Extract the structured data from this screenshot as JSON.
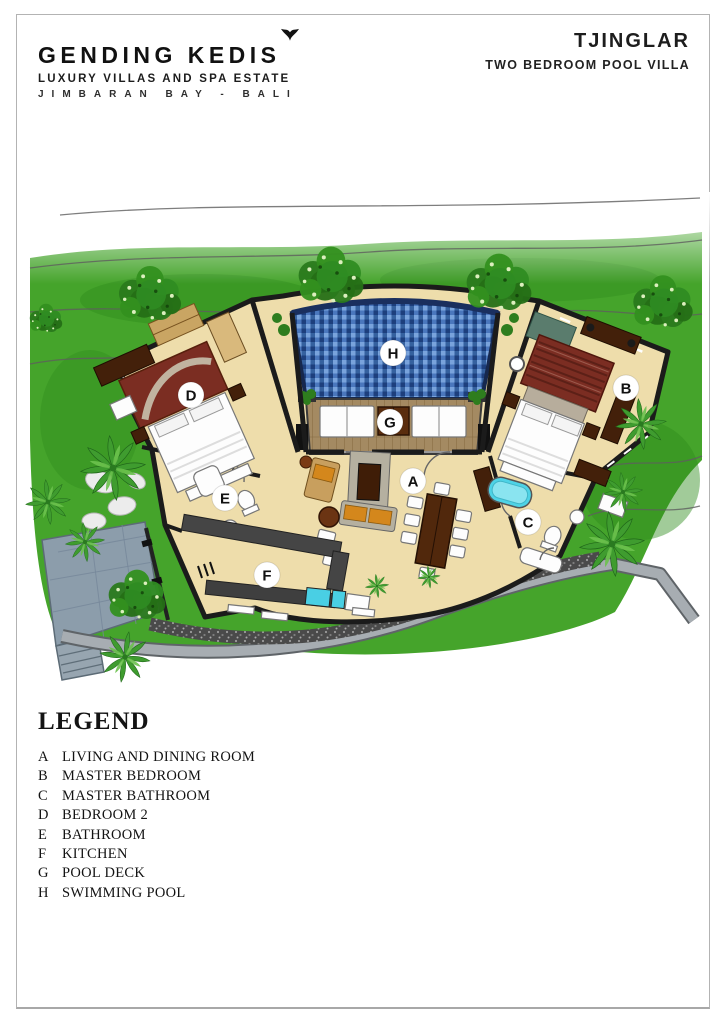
{
  "header": {
    "brand": {
      "name": "GENDING KEDIS",
      "tagline": "LUXURY VILLAS AND SPA ESTATE",
      "location": "JIMBARAN BAY  -  BALI",
      "logo_mark": "bird-icon"
    },
    "villa": {
      "name": "TJINGLAR",
      "type": "TWO BEDROOM POOL VILLA"
    }
  },
  "plan": {
    "room_labels": [
      {
        "letter": "A",
        "x": 413,
        "y": 481
      },
      {
        "letter": "B",
        "x": 626,
        "y": 388
      },
      {
        "letter": "C",
        "x": 528,
        "y": 522
      },
      {
        "letter": "D",
        "x": 191,
        "y": 395
      },
      {
        "letter": "E",
        "x": 225,
        "y": 498
      },
      {
        "letter": "F",
        "x": 267,
        "y": 575
      },
      {
        "letter": "G",
        "x": 390,
        "y": 422
      },
      {
        "letter": "H",
        "x": 393,
        "y": 353
      }
    ],
    "colors": {
      "grass": "#45a42b",
      "grass_dark": "#2f8c1d",
      "floor": "#eeddab",
      "wall": "#1b1b1b",
      "pool_c1": "#79a3dc",
      "pool_c2": "#4a77bd",
      "pool_c3": "#1d3f7d",
      "pool_c4": "#35619f",
      "pool_border": "#16284e",
      "wood": "#a48a62",
      "wood_line": "#83683f",
      "road": "#a7adb2",
      "road_edge": "#5f6468",
      "gravel": "#4a4a4a",
      "stone": "#8c9dab",
      "rug": "#7b2d22",
      "tub": "#4ed3e6",
      "furniture_dark": "#43200a",
      "cushion": "#d4871c",
      "label_bg": "#ffffff",
      "label_text": "#111111"
    }
  },
  "legend": {
    "heading": "LEGEND",
    "items": [
      {
        "key": "A",
        "label": "LIVING AND DINING ROOM"
      },
      {
        "key": "B",
        "label": "MASTER BEDROOM"
      },
      {
        "key": "C",
        "label": "MASTER BATHROOM"
      },
      {
        "key": "D",
        "label": "BEDROOM 2"
      },
      {
        "key": "E",
        "label": "BATHROOM"
      },
      {
        "key": "F",
        "label": "KITCHEN"
      },
      {
        "key": "G",
        "label": "POOL DECK"
      },
      {
        "key": "H",
        "label": "SWIMMING POOL"
      }
    ]
  }
}
